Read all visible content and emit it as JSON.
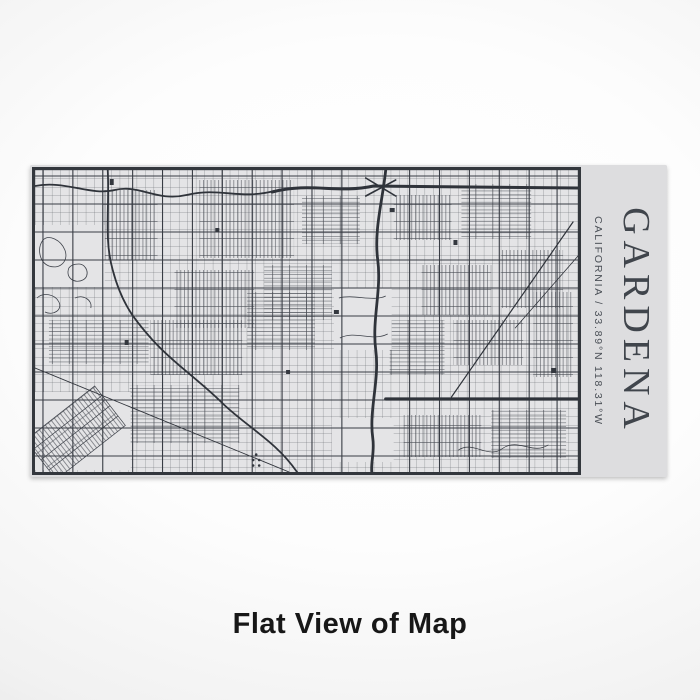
{
  "product": {
    "label": {
      "title": "GARDENA",
      "subtitle": "CALIFORNIA / 33.89°N 118.31°W"
    }
  },
  "caption": {
    "text": "Flat View of Map"
  },
  "colors": {
    "map_background": "#e4e4e6",
    "map_streets": "#3e424a",
    "map_freeways": "#2f333a",
    "map_border": "#33373d",
    "label_panel_background": "#dddddf",
    "label_text": "#40454c",
    "caption_text": "#171717",
    "backdrop_edge": "#d9d9d9"
  }
}
